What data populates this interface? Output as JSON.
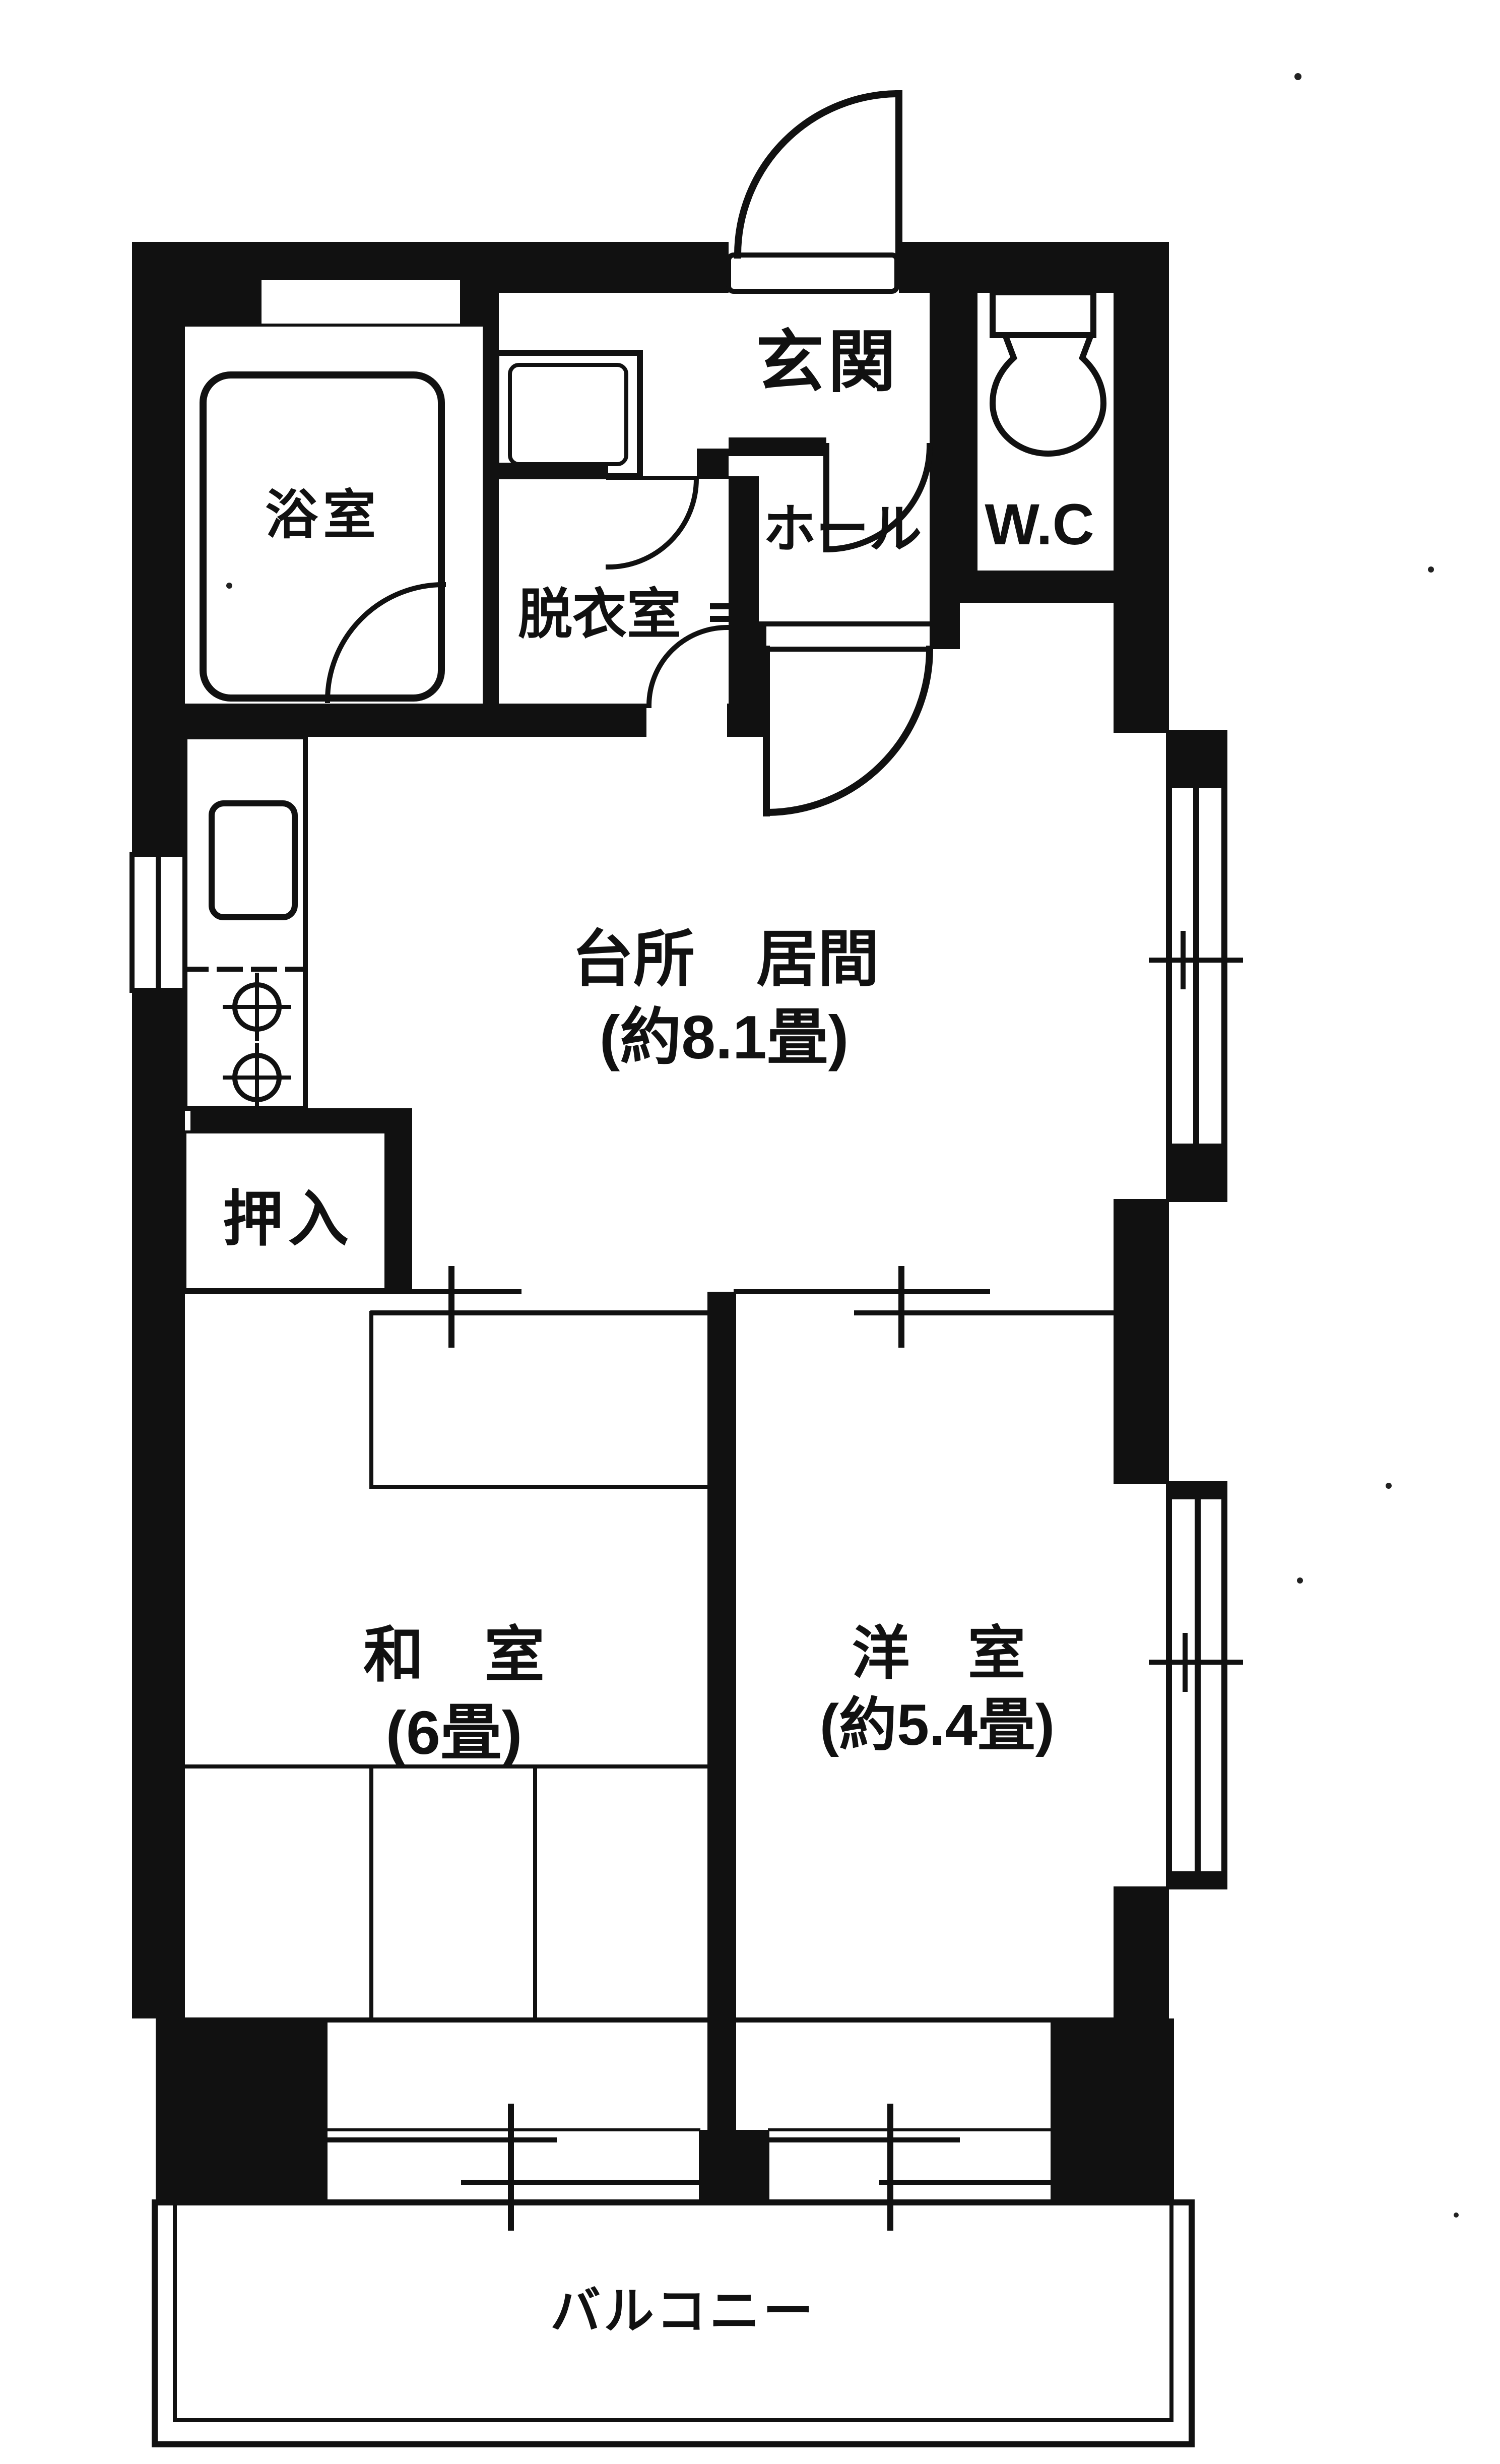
{
  "plan": {
    "background": "#ffffff",
    "ink": "#111111",
    "rooms": [
      {
        "name": "entrance",
        "label": "玄関"
      },
      {
        "name": "toilet-room",
        "label": "W.C"
      },
      {
        "name": "hall",
        "label": "ホール"
      },
      {
        "name": "bathroom",
        "label": "浴室"
      },
      {
        "name": "dressing-room",
        "label": "脱衣室"
      },
      {
        "name": "kitchen-living",
        "label": "台所　居間",
        "size_label": "(約8.1畳)"
      },
      {
        "name": "closet",
        "label": "押入"
      },
      {
        "name": "japanese-room",
        "label": "和　室",
        "size_label": "(6畳)"
      },
      {
        "name": "western-room",
        "label": "洋　室",
        "size_label": "(約5.4畳)"
      },
      {
        "name": "balcony",
        "label": "バルコニー"
      }
    ],
    "fixtures": [
      "bathtub-icon",
      "toilet-bowl-icon",
      "washing-machine-pan-icon",
      "kitchen-sink-icon",
      "stove-burner-icon",
      "stove-burner-icon"
    ],
    "symbols": [
      "hinged-door-arc",
      "sliding-door-double-line",
      "sliding-window-bump",
      "tatami-grid-lines"
    ]
  }
}
